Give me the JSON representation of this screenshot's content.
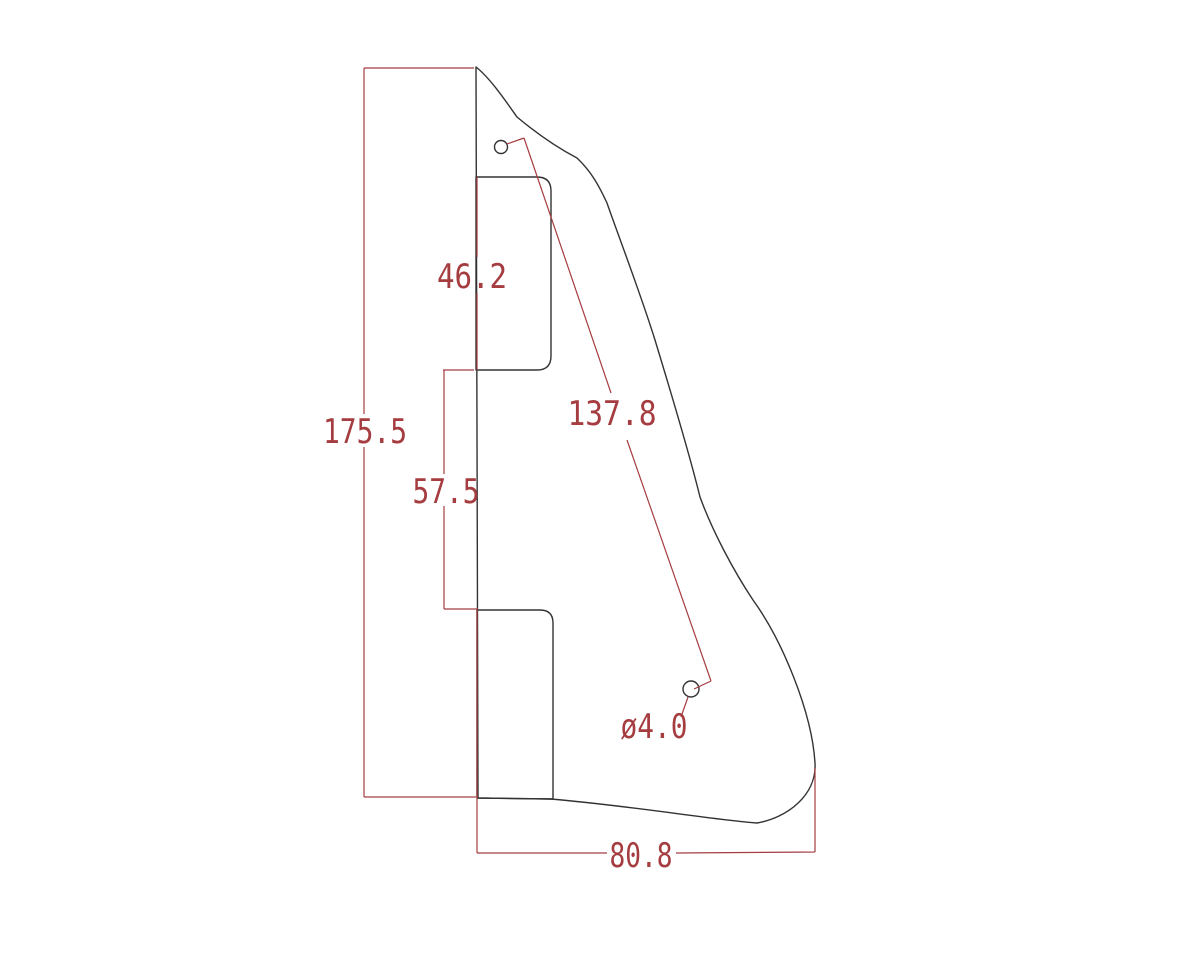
{
  "colors": {
    "background": "#ffffff",
    "outline": "#333333",
    "dimension": "#a53c40"
  },
  "drawing": {
    "type": "technical-drawing",
    "subject": "pickguard outline with two pickup cutouts, two screw holes and dimension annotations",
    "dimensions": {
      "total_height": "175.5",
      "upper_cutout_height": "46.2",
      "edge_between_cutouts": "57.5",
      "screw_hole_spacing": "137.8",
      "screw_hole_diameter": "ø4.0",
      "bottom_width": "80.8"
    }
  }
}
